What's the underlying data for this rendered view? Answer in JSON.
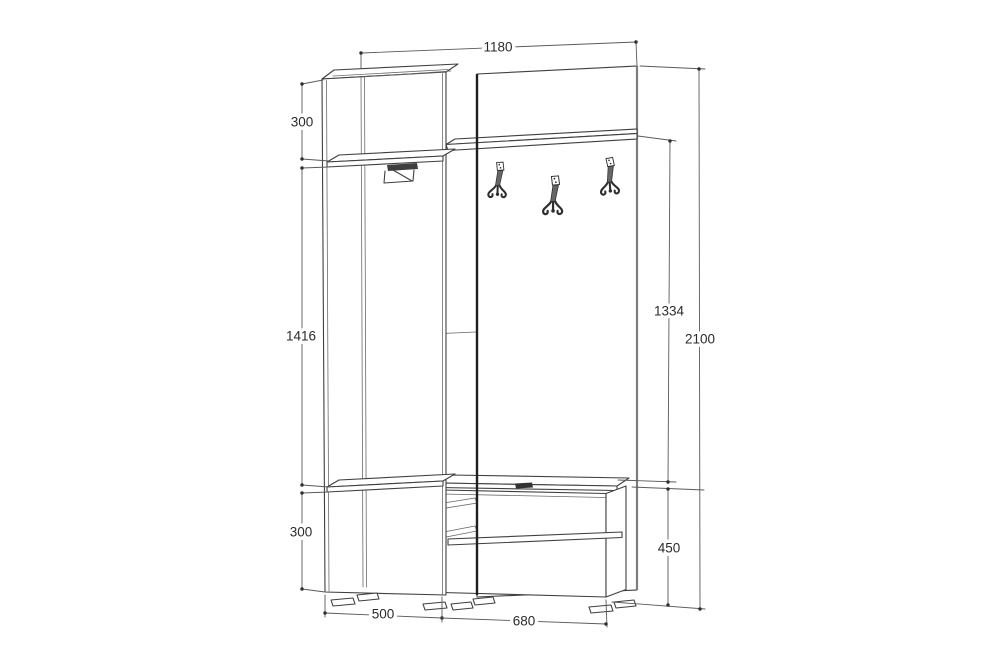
{
  "page": {
    "background": "#ffffff"
  },
  "diagram": {
    "type": "furniture-dimension-drawing",
    "subject": "hallway wardrobe set: tall cabinet with clothes rail, coat-hook back panel with shelf, shoe bench",
    "line_color": "#3f3f3f",
    "dimension_line_color": "#5a5a5a",
    "dimensions": {
      "total_width": "1180",
      "cabinet_top_section_height": "300",
      "cabinet_middle_section_height": "1416",
      "cabinet_bottom_section_height": "300",
      "shelf_to_bench_height": "1334",
      "total_height": "2100",
      "bench_height": "450",
      "cabinet_width": "500",
      "bench_width": "680"
    },
    "components": [
      {
        "name": "back-panel"
      },
      {
        "name": "wall-shelf"
      },
      {
        "name": "coat-hooks",
        "count": 3
      },
      {
        "name": "wardrobe-cabinet"
      },
      {
        "name": "clothes-rail"
      },
      {
        "name": "shoe-bench"
      },
      {
        "name": "feet",
        "count": 7
      }
    ]
  }
}
